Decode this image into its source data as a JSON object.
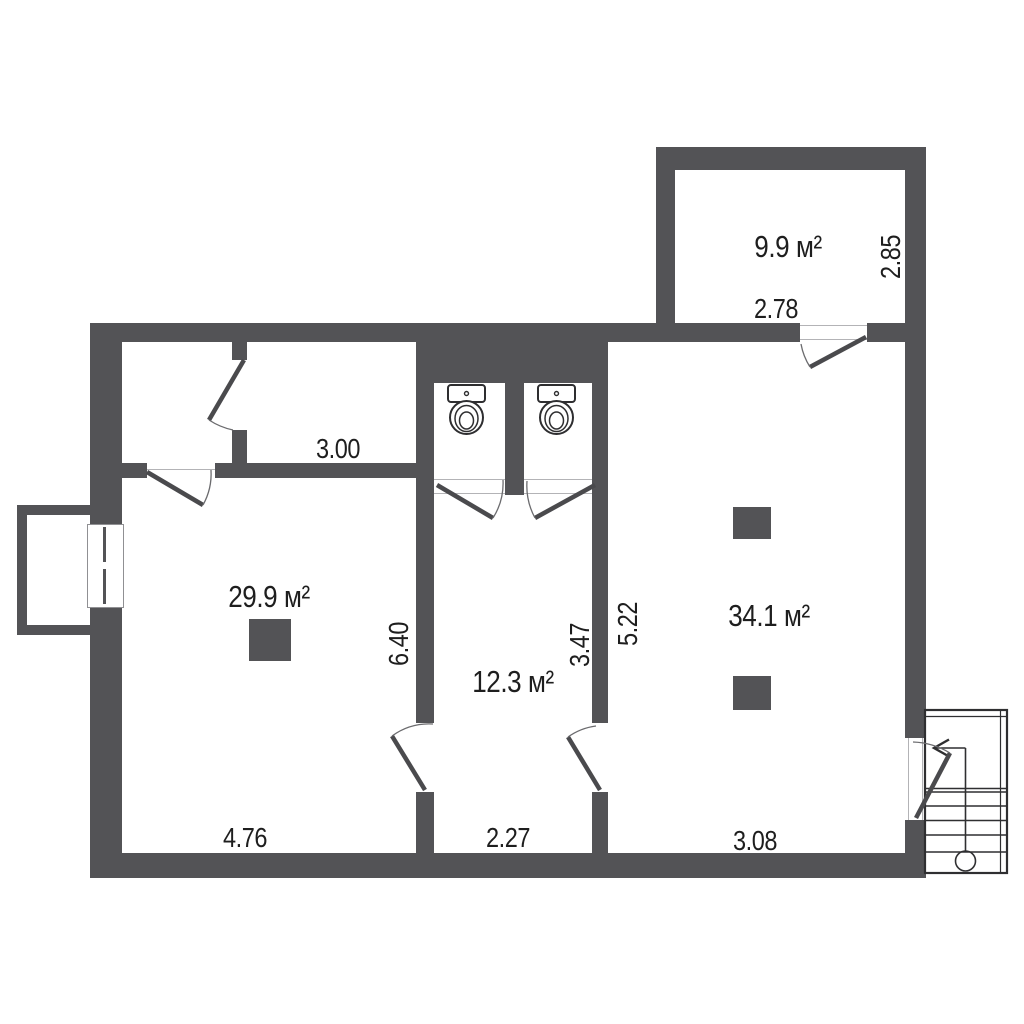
{
  "colors": {
    "wall": "#535356",
    "door_leaf": "#4a4a4d",
    "text": "#1e1e1e",
    "background": "#ffffff"
  },
  "rooms": [
    {
      "name": "annex-top-right",
      "area": "9.9 м²",
      "width": "2.78",
      "depth": "2.85"
    },
    {
      "name": "top-room",
      "width": "3.00"
    },
    {
      "name": "left-room",
      "area": "29.9 м²",
      "width": "4.76",
      "depth": "6.40"
    },
    {
      "name": "middle-room",
      "area": "12.3 м²",
      "width": "2.27",
      "depth": "3.47"
    },
    {
      "name": "right-room",
      "area": "34.1 м²",
      "width": "3.08",
      "depth": "5.22"
    }
  ],
  "fixtures": {
    "toilets": 2,
    "columns": 3,
    "staircase": "bottom-right, up-arrow with start circle",
    "window": "left exterior wall",
    "porch": "left outside"
  }
}
